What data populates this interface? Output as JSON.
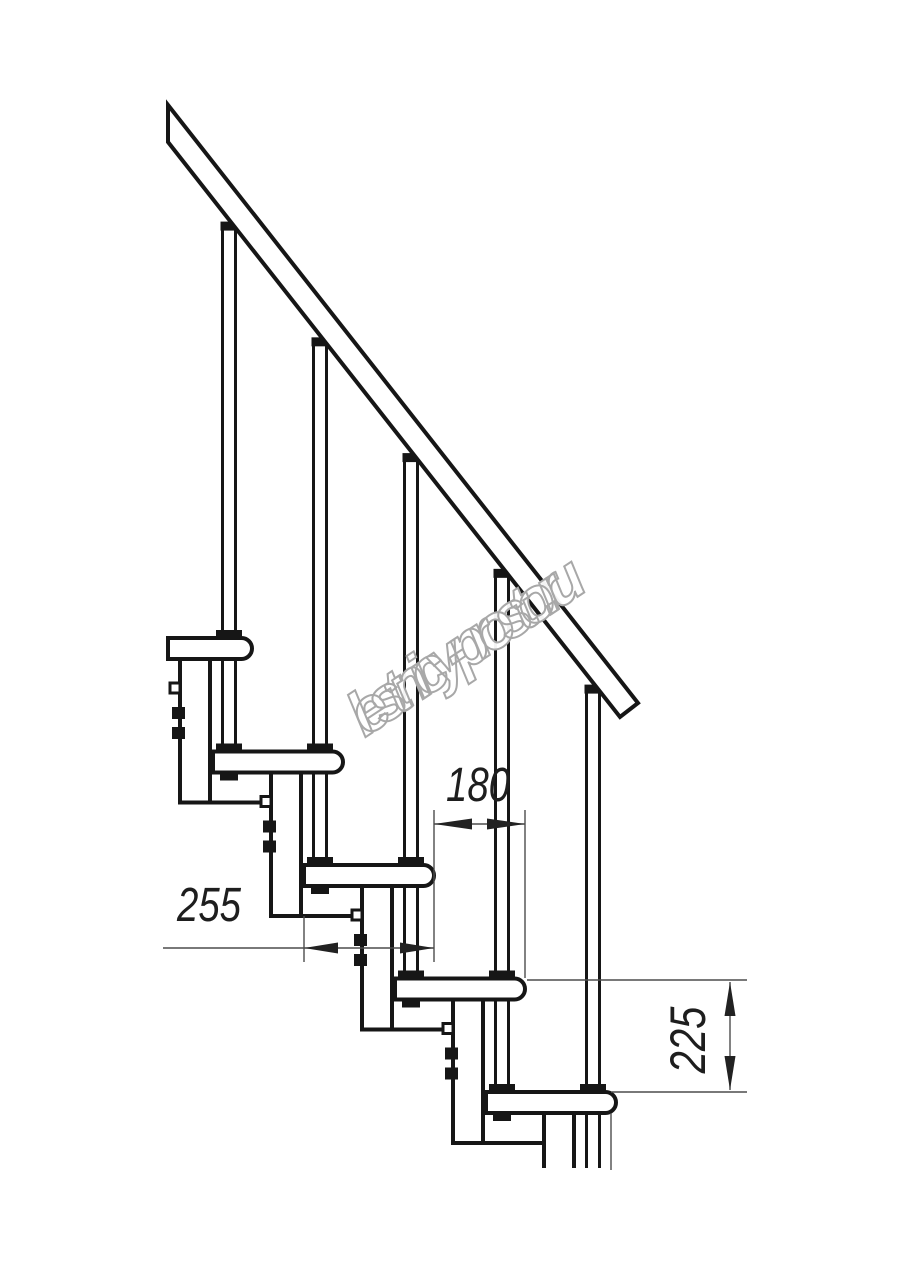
{
  "page": {
    "background": "#ffffff"
  },
  "drawing": {
    "type": "technical-drawing",
    "subject": "modular staircase side view fragment",
    "watermark": {
      "text": "lestnicy-prosto.ru"
    },
    "dimension_labels": {
      "run": "180",
      "depth": "255",
      "rise": "225"
    },
    "colors": {
      "line": "#161616",
      "thin_line": "#4d4d4d",
      "arrow": "#222222",
      "fill": "#ffffff",
      "watermark_stroke": "#a8a8a8"
    },
    "geometry": {
      "canvas": {
        "w": 914,
        "h": 1280
      },
      "cut_y": 1168,
      "rail": {
        "polygon": [
          [
            168,
            105
          ],
          [
            638,
            703
          ],
          [
            620,
            717
          ],
          [
            168,
            142
          ]
        ],
        "bottom_x0": 168,
        "bottom_y0": 142,
        "slope": 1.272
      },
      "modules": {
        "count": 5,
        "dx": 91,
        "dy": 113.5,
        "tread_left": 122,
        "first_tread_left": 168,
        "tread_top": 638,
        "tread_h": 21,
        "nose_x": 252,
        "baluster_x": 229,
        "baluster_half_gap": 6.5,
        "column_left": 180,
        "column_w": 30,
        "column_drop": 164.5,
        "tab_white_dy": 45,
        "tab_black_dy1": 69,
        "tab_black_dy2": 89
      },
      "dims": {
        "d180": {
          "line": [
            434,
            824,
            525,
            824
          ],
          "arrows": [
            [
              434,
              824,
              "left",
              38
            ],
            [
              525,
              824,
              "right",
              38
            ]
          ],
          "ext_v": [
            [
              434,
              810,
              962
            ],
            [
              525,
              810,
              978
            ]
          ]
        },
        "d255": {
          "line": [
            163,
            948,
            434,
            948
          ],
          "arrows": [
            [
              304,
              948,
              "left",
              34
            ],
            [
              434,
              948,
              "right",
              34
            ]
          ],
          "ext_v": [
            [
              304,
              916,
              962
            ]
          ]
        },
        "d225": {
          "line": [
            730,
            982,
            730,
            1090
          ],
          "arrows": [
            [
              730,
              982,
              "up",
              34
            ],
            [
              730,
              1090,
              "down",
              34
            ]
          ],
          "ext_h": [
            [
              527,
              747,
              980
            ],
            [
              611,
              747,
              1092
            ]
          ]
        },
        "extra_v": [
          [
            611,
            1113,
            1170
          ]
        ]
      }
    }
  }
}
